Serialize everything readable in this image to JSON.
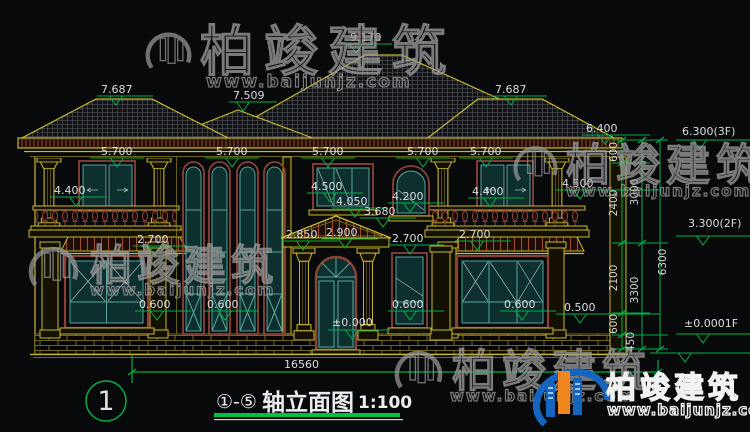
{
  "drawing": {
    "title_prefix": "①-⑤",
    "title": "轴立面图",
    "scale": "1:100",
    "axis_bubble": "1",
    "total_width_mm": "16560"
  },
  "levels": {
    "ridge": "9.170",
    "side_roof": "7.687",
    "mid_roof": "7.509",
    "gutter": "6.400",
    "eave": "5.700",
    "win2f_top": "4.500",
    "balcony_door_top": "4.400",
    "win2f_arch_top": "4.200",
    "win2f_sill_a": "4.050",
    "win2f_sill_b": "3.680",
    "porch_ridge": "2.900",
    "porch_eave": "2.850",
    "win1f_top": "2.700",
    "win1f_sill": "0.600",
    "plinth": "0.500",
    "floor1_zero": "±0.000"
  },
  "floor_marks": {
    "f3": "6.300(3F)",
    "f2": "3.300(2F)",
    "f1": "±0.0001F"
  },
  "vertical_dims": {
    "d600": "600",
    "d2400": "2400",
    "d2100": "2100",
    "d450": "450",
    "d3000": "3000",
    "d3300": "3300",
    "d6300": "6300"
  },
  "watermark": {
    "brand": "柏竣建筑",
    "url": "www.baijunjz.com"
  },
  "logo": {
    "brand": "柏竣建筑",
    "url": "www.baijunjz.com"
  },
  "colors": {
    "background": "#08090b",
    "line_yellow": "#c9b92e",
    "dim_green": "#00ae46",
    "text_white": "#dcdcdc",
    "frame_maroon": "#8a4236",
    "glass_teal": "#58a49c",
    "logo_blue": "#1565c0",
    "logo_orange": "#f0861e"
  }
}
